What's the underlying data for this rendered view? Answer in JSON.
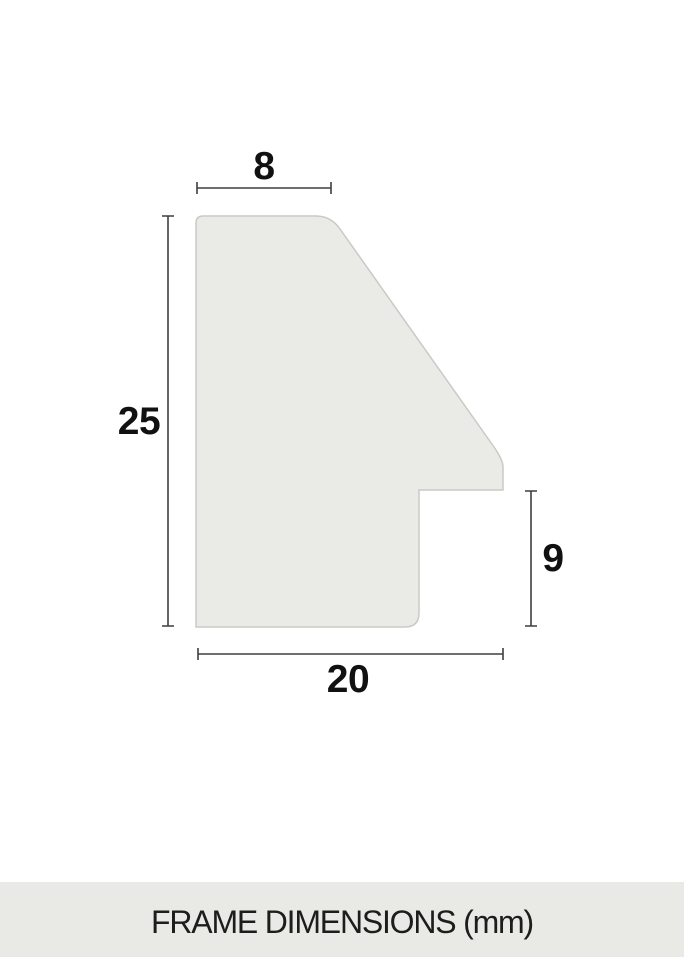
{
  "title": "FRAME DIMENSIONS (mm)",
  "diagram": {
    "dimensions": {
      "top_width": "8",
      "total_height": "25",
      "rabbet_height": "9",
      "bottom_width": "20"
    }
  },
  "colors": {
    "page_bg": "#ffffff",
    "shape_fill": "#eaeae7",
    "shape_stroke": "#c9c9c6",
    "dim_line": "#3f3f3f",
    "dim_text": "#111111",
    "footer_bg": "#e9e9e5",
    "footer_text": "#1d1d1b"
  }
}
